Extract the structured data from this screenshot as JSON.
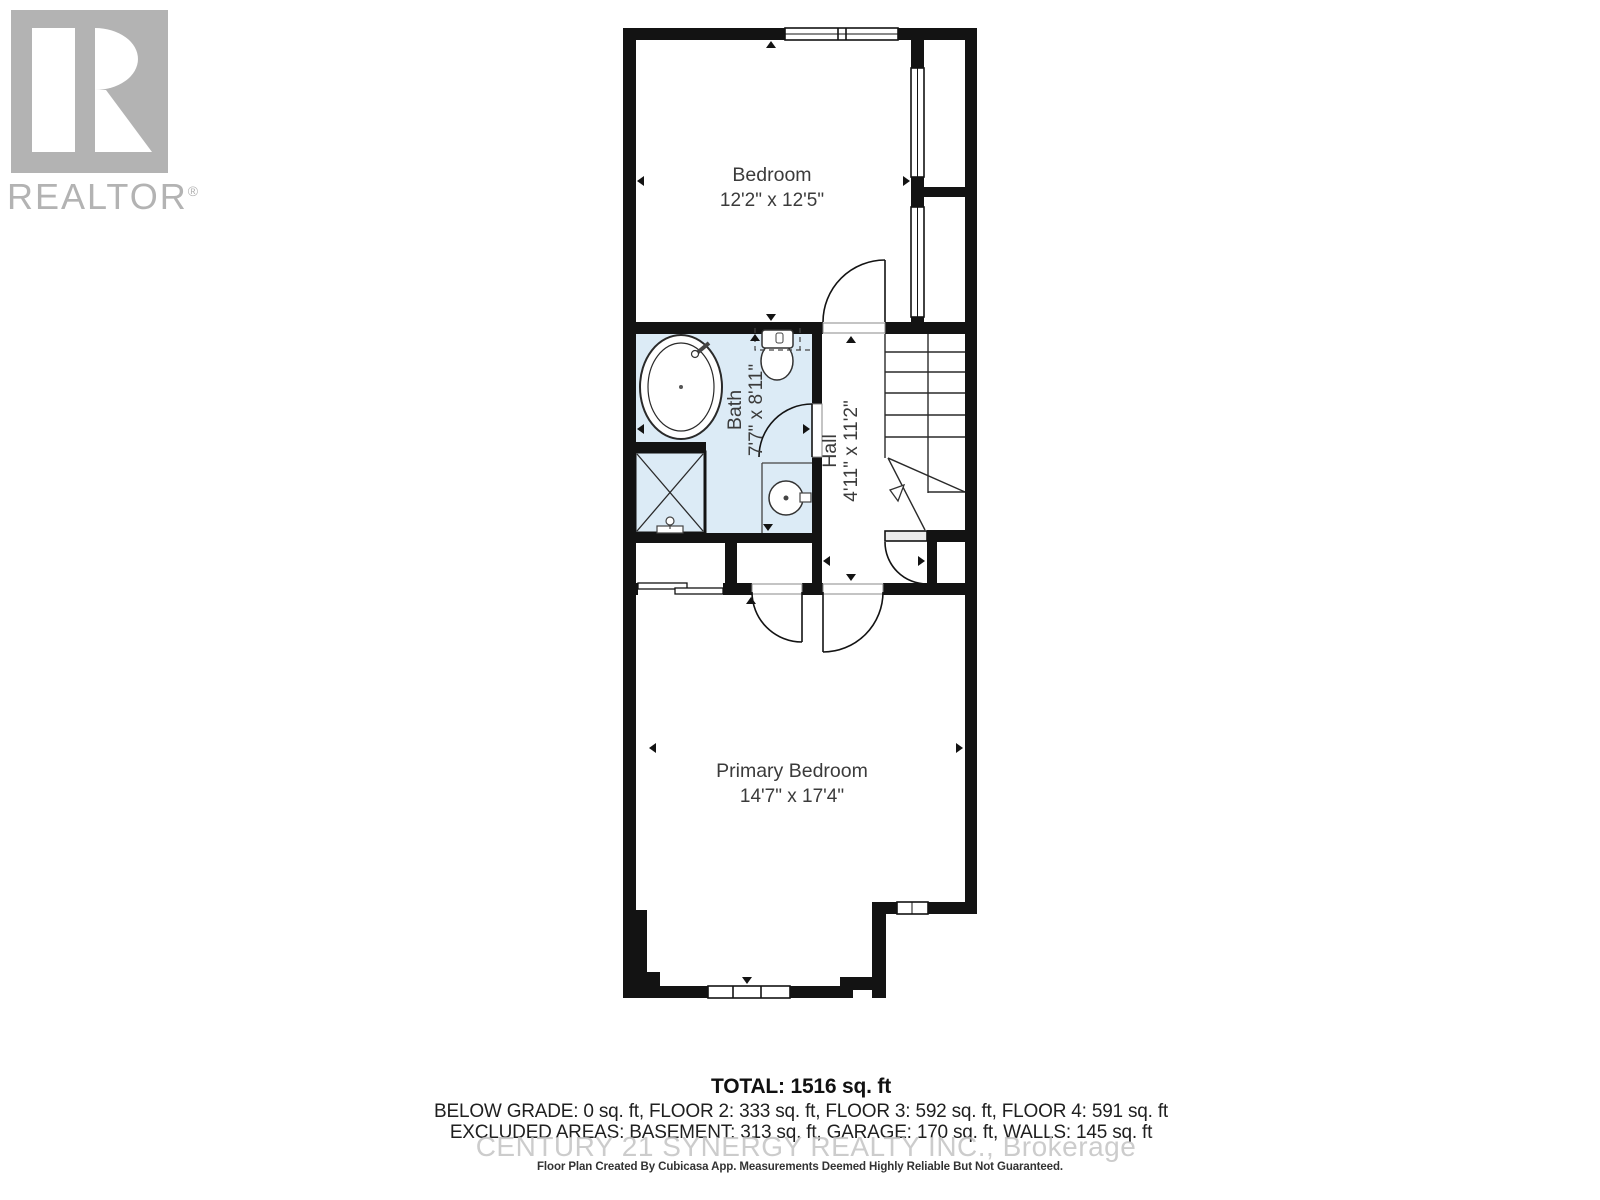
{
  "logo": {
    "brand": "REALTOR",
    "registered": "®"
  },
  "rooms": {
    "bedroom": {
      "name": "Bedroom",
      "dims": "12'2\" x 12'5\""
    },
    "bath": {
      "name": "Bath",
      "dims": "7'7\" x 8'11\""
    },
    "hall": {
      "name": "Hall",
      "dims": "4'11\" x 11'2\""
    },
    "primary": {
      "name": "Primary Bedroom",
      "dims": "14'7\" x 17'4\""
    }
  },
  "summary": {
    "total": "TOTAL: 1516 sq. ft",
    "floors": "BELOW GRADE: 0 sq. ft, FLOOR 2: 333 sq. ft, FLOOR 3: 592 sq. ft, FLOOR 4: 591 sq. ft",
    "excluded": "EXCLUDED AREAS: BASEMENT: 313 sq. ft, GARAGE: 170 sq. ft, WALLS: 145 sq. ft",
    "watermark": "CENTURY 21 SYNERGY REALTY INC., Brokerage",
    "disclaimer": "Floor Plan Created By Cubicasa App. Measurements Deemed Highly Reliable But Not Guaranteed."
  },
  "colors": {
    "wall": "#131313",
    "bath_fill": "#dcebf6",
    "label": "#3b3b3b",
    "logo_gray": "#b3b3b3",
    "watermark_gray": "#c2c2c2"
  }
}
